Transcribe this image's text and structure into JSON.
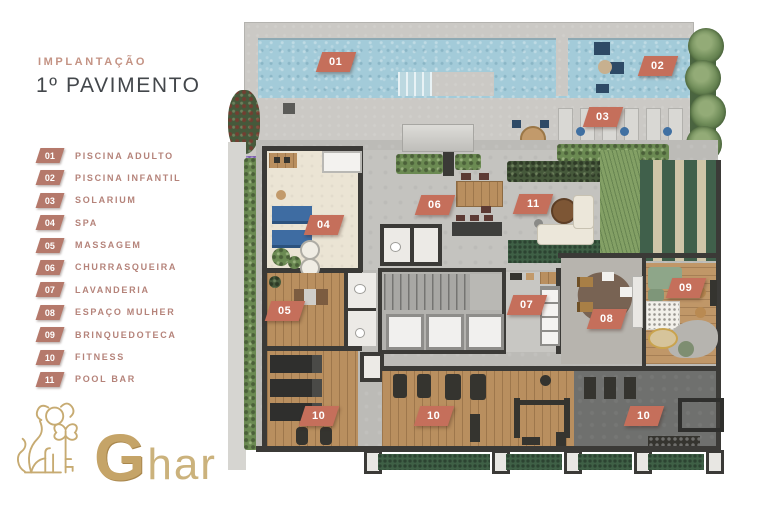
{
  "header": {
    "eyebrow": "IMPLANTAÇÃO",
    "title": "1º PAVIMENTO"
  },
  "legend": {
    "items": [
      {
        "num": "01",
        "label": "PISCINA ADULTO"
      },
      {
        "num": "02",
        "label": "PISCINA INFANTIL"
      },
      {
        "num": "03",
        "label": "SOLARIUM"
      },
      {
        "num": "04",
        "label": "SPA"
      },
      {
        "num": "05",
        "label": "MASSAGEM"
      },
      {
        "num": "06",
        "label": "CHURRASQUEIRA"
      },
      {
        "num": "07",
        "label": "LAVANDERIA"
      },
      {
        "num": "08",
        "label": "ESPAÇO MULHER"
      },
      {
        "num": "09",
        "label": "BRINQUEDOTECA"
      },
      {
        "num": "10",
        "label": "FITNESS"
      },
      {
        "num": "11",
        "label": "POOL BAR"
      }
    ]
  },
  "plan": {
    "badges": [
      {
        "num": "01",
        "area": "piscina-adulto"
      },
      {
        "num": "02",
        "area": "piscina-infantil"
      },
      {
        "num": "03",
        "area": "solarium"
      },
      {
        "num": "04",
        "area": "spa"
      },
      {
        "num": "05",
        "area": "massagem"
      },
      {
        "num": "06",
        "area": "churrasqueira"
      },
      {
        "num": "07",
        "area": "lavanderia"
      },
      {
        "num": "08",
        "area": "espaco-mulher"
      },
      {
        "num": "09",
        "area": "brinquedoteca"
      },
      {
        "num": "10",
        "area": "fitness-esteiras"
      },
      {
        "num": "10",
        "area": "fitness-aparelhos"
      },
      {
        "num": "10",
        "area": "fitness-peso-livre"
      },
      {
        "num": "11",
        "area": "pool-bar"
      }
    ]
  },
  "logo": {
    "monogram": "G",
    "wordmark_rest": "har"
  },
  "colors": {
    "plan_badge": "#c56f5b",
    "legend_badge": "#b5796b",
    "legend_text": "#b5837a",
    "eyebrow": "#c49384",
    "title": "#43474b",
    "gold": "#c5a468",
    "water": "#a3cbd9"
  }
}
